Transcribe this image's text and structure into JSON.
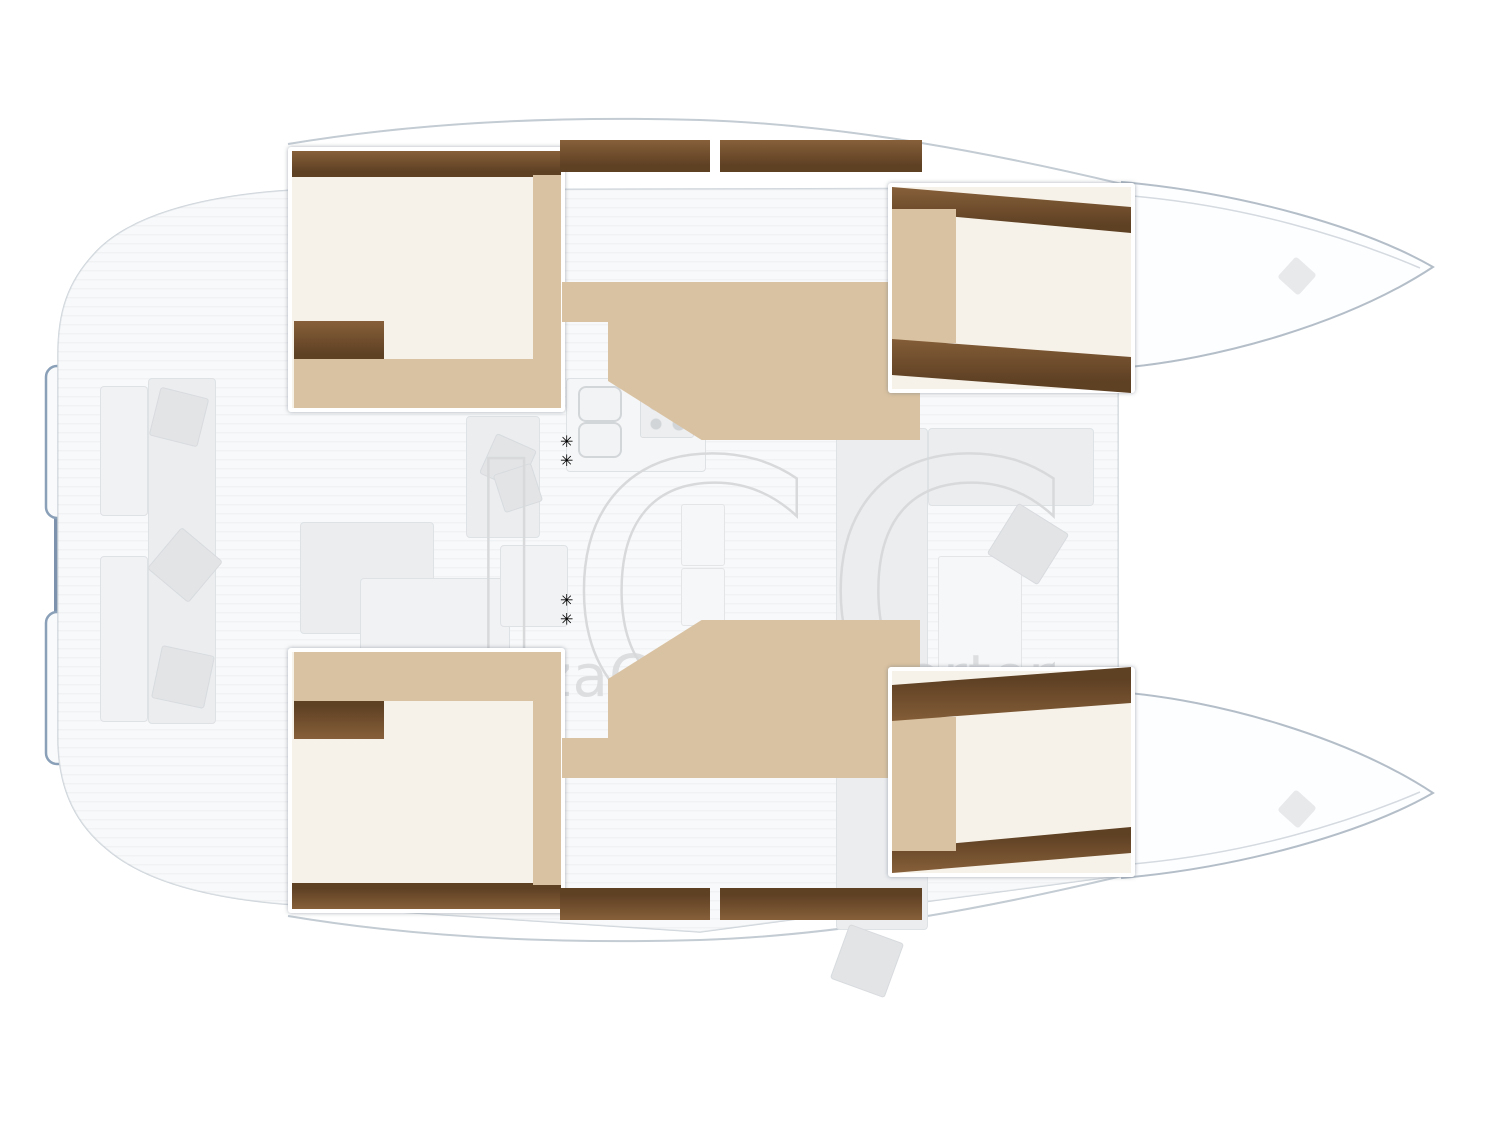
{
  "watermark": {
    "initials": "ICC",
    "text": "IbizaCentralCharter"
  },
  "colors": {
    "wood_dark": "#5e4023",
    "wood_mid": "#87603a",
    "wood_light": "#d9c2a1",
    "bed": "#d8c6a7",
    "bed_shade": "#c6b089",
    "sheet": "#faf9f6",
    "pillow_light": "#9cbbe8",
    "pillow": "#6d98d8",
    "pillow_dark": "#2c59a6",
    "bath_counter": "#bfe6f7",
    "bath_deep": "#9ed8f0",
    "shower": "#3fc0ec",
    "toilet_outline": "#9fabb4",
    "ghost": "#ebedef",
    "ghost_line": "#dfe2e5",
    "hull_outline": "#b4bec9",
    "stern_edge": "#7d93ad",
    "watermark": "#d7d9db"
  }
}
